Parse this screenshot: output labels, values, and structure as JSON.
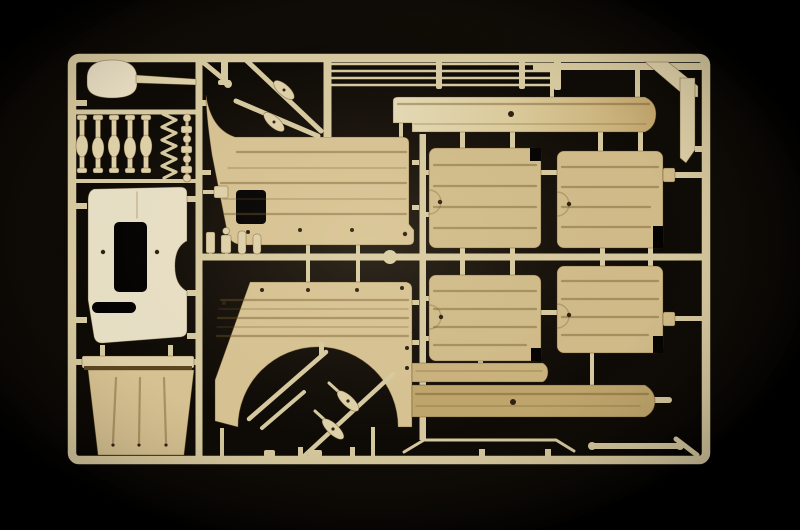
{
  "scene": {
    "description": "Photograph of a tan injection-molded plastic model kit sprue (parts tree) with vehicle body panels, floor boards, a shovel and small fittings, lit from the centre on a black background",
    "colors": {
      "background": "#000000",
      "glow": "#2a2014",
      "runner": "#d9cca2",
      "plastic_bright": "#eae2c8",
      "plastic_light": "#e0d3ab",
      "plastic_mid": "#d8c494",
      "plastic_panel": "#d2bd8b",
      "plastic_deep": "#cbb47e",
      "plastic_dark": "#c0a76d",
      "groove": "#6b5224",
      "shade": "#5b4521",
      "rivet": "#2c1f0e"
    },
    "parts": [
      {
        "id": "sprue-frame",
        "label": "Rectangular sprue frame with runner bars"
      },
      {
        "id": "shovel",
        "label": "Shovel blade with long handle"
      },
      {
        "id": "pioneer-tools",
        "label": "Row of five small clamp parts"
      },
      {
        "id": "spring-strip",
        "label": "Zig-zag spring strip"
      },
      {
        "id": "fittings-strip",
        "label": "Column of small round and square fittings"
      },
      {
        "id": "bulkhead-panel",
        "label": "Bright flat bulkhead panel with rectangular opening and slot"
      },
      {
        "id": "stowage-box-panel",
        "label": "Trapezoidal stowage box panel with three grooves"
      },
      {
        "id": "body-side-panel-upper",
        "label": "Ribbed body side panel with corner fillet and small opening"
      },
      {
        "id": "paddle-levers-upper",
        "label": "Two diagonal runners carrying oval paddle levers"
      },
      {
        "id": "tie-rods",
        "label": "Four long thin tie rods with link connectors"
      },
      {
        "id": "side-board-panel",
        "label": "Long narrow side board panel with rivet hole"
      },
      {
        "id": "body-side-panel-lower",
        "label": "Ribbed body side panel with semicircular wheel arch"
      },
      {
        "id": "paddle-levers-lower",
        "label": "Diagonal runners with two drilled oval paddle levers inside wheel arch"
      },
      {
        "id": "fender-strip-panel",
        "label": "Short fender strip panel"
      },
      {
        "id": "sill-panel",
        "label": "Long sill panel with rounded end and rivet hole"
      },
      {
        "id": "floor-panels",
        "label": "Four ribbed floor panels in a two-by-two grid with rivet tabs"
      },
      {
        "id": "corner-bars",
        "label": "Angled corner brace and flat vertical bar at top right"
      },
      {
        "id": "small-fittings",
        "label": "Small cylindrical fittings above the centre runner"
      }
    ]
  }
}
